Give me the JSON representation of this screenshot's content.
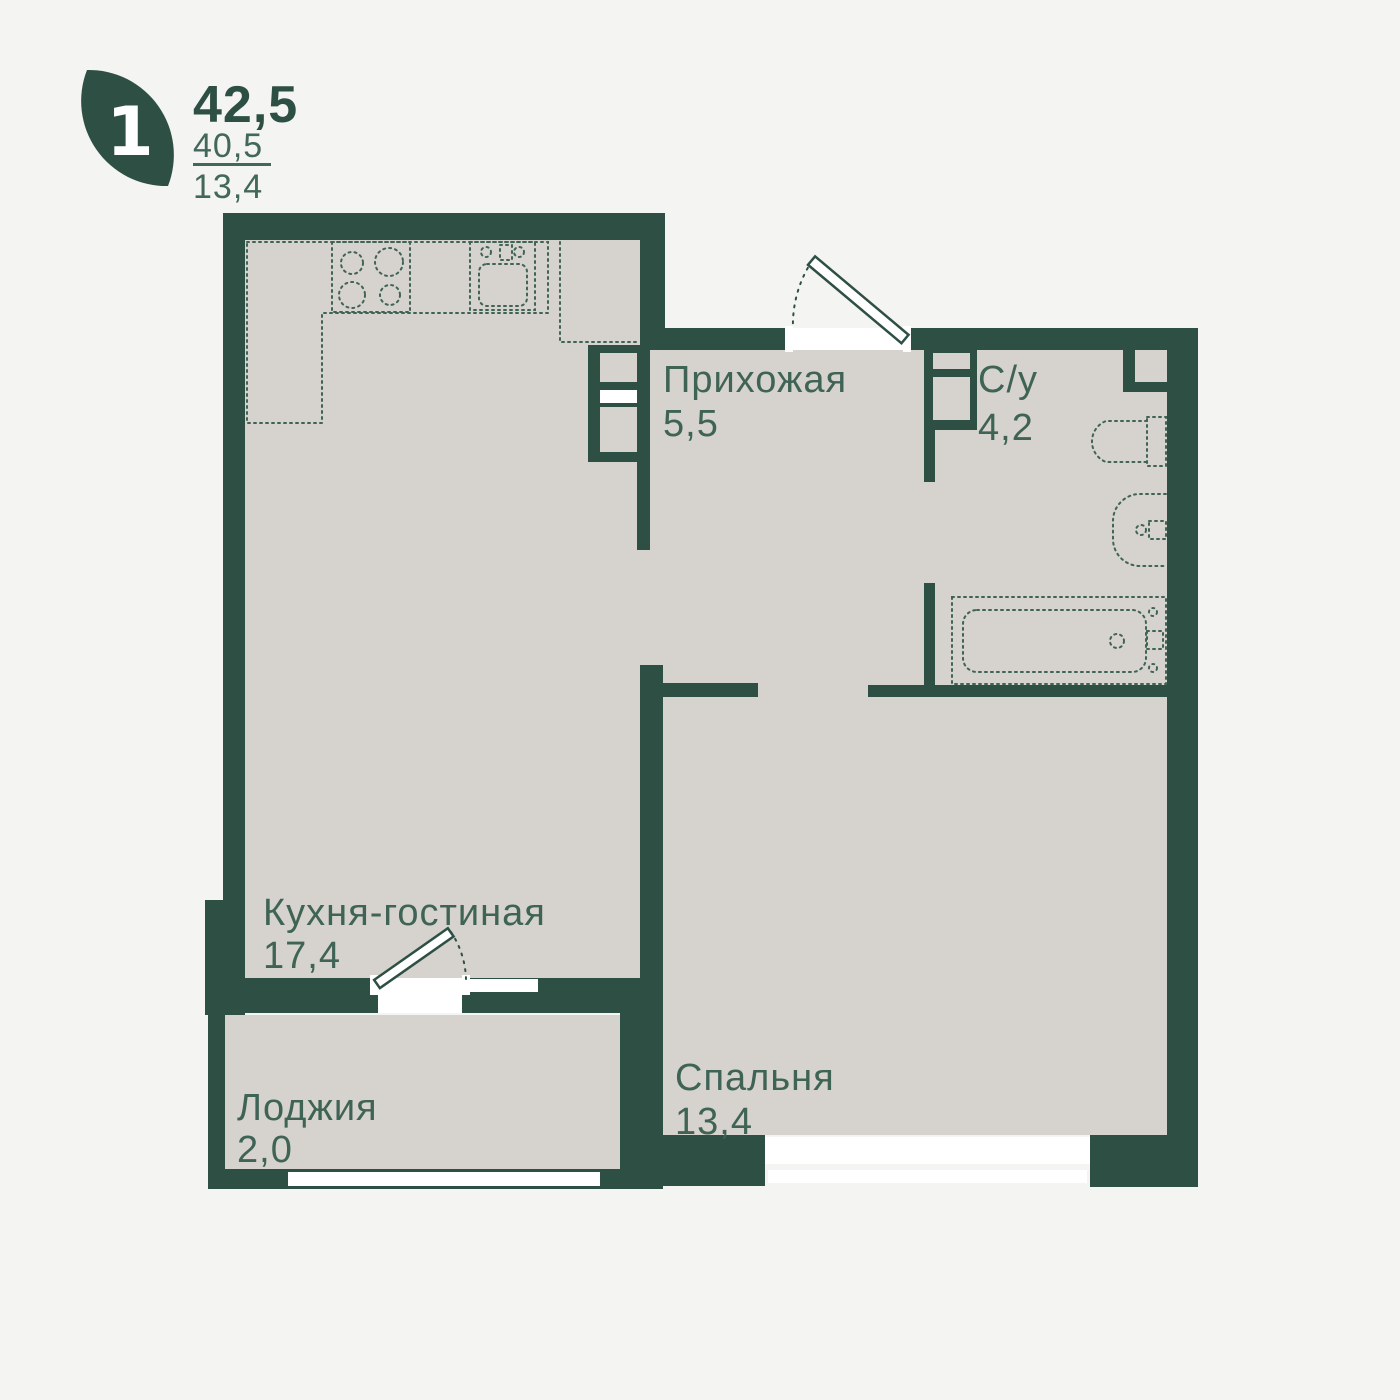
{
  "badge": {
    "rooms_count": "1",
    "total_area": "42,5",
    "living_area": "40,5",
    "kitchen_area": "13,4"
  },
  "rooms": [
    {
      "id": "kitchen-living",
      "name": "Кухня-гостиная",
      "area": "17,4"
    },
    {
      "id": "hallway",
      "name": "Прихожая",
      "area": "5,5"
    },
    {
      "id": "bathroom",
      "name": "С/у",
      "area": "4,2"
    },
    {
      "id": "bedroom",
      "name": "Спальня",
      "area": "13,4"
    },
    {
      "id": "loggia",
      "name": "Лоджия",
      "area": "2,0"
    }
  ],
  "fixtures": [
    "stove-icon",
    "kitchen-sink-icon",
    "fridge-icon",
    "toilet-icon",
    "bathroom-sink-icon",
    "bathtub-icon",
    "entrance-door-icon",
    "balcony-door-icon",
    "window-icon",
    "vent-shaft-icon",
    "leaf-logo-icon"
  ],
  "colors": {
    "wall": "#2e5044",
    "floor": "#d6d2cd",
    "background": "#f4f4f2",
    "accent_text": "#3f6456",
    "white": "#ffffff"
  }
}
